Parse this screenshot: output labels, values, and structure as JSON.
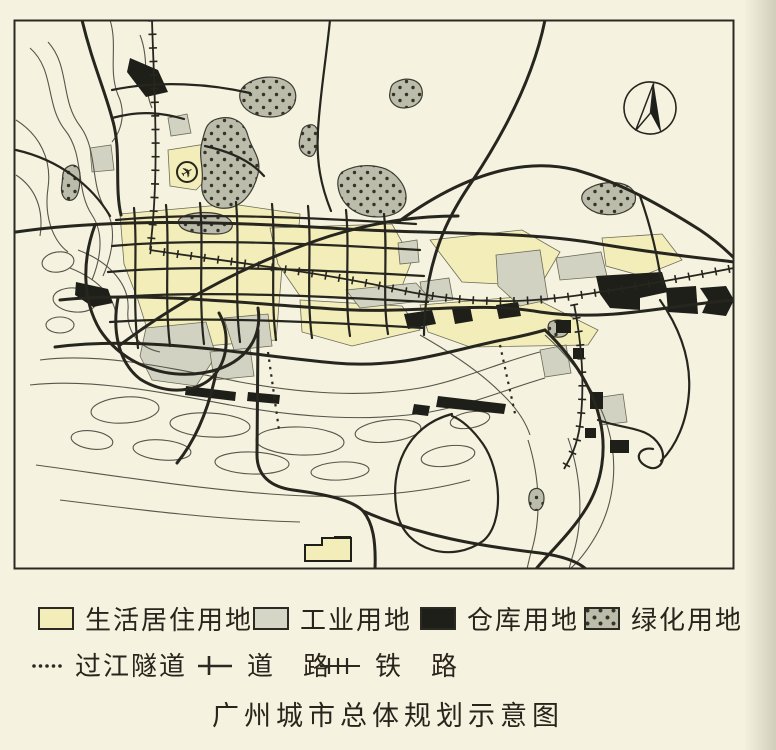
{
  "title": "广州城市总体规划示意图",
  "legend": {
    "area_items": [
      {
        "name": "residential",
        "label": "生活居住用地",
        "color": "#f3edba"
      },
      {
        "name": "industrial",
        "label": "工业用地",
        "color": "#d6d6c6"
      },
      {
        "name": "warehouse",
        "label": "仓库用地",
        "color": "#1f1f1a"
      },
      {
        "name": "green-space",
        "label": "绿化用地",
        "color": "#bcbcab",
        "pattern": "stippled-dots"
      }
    ],
    "line_items": [
      {
        "name": "river-tunnel",
        "label": "过江隧道",
        "symbol": "dotted-line"
      },
      {
        "name": "road",
        "label": "道　路",
        "symbol": "line-with-tick"
      },
      {
        "name": "railway",
        "label": "铁　路",
        "symbol": "line-with-cross-ticks"
      }
    ]
  },
  "map": {
    "compass": "north-arrow",
    "airport_marker": "airplane-in-circle",
    "colors": {
      "paper": "#f5f2df",
      "ink": "#26261f",
      "water_line": "#56564b",
      "green_dot": "#33332a"
    }
  }
}
